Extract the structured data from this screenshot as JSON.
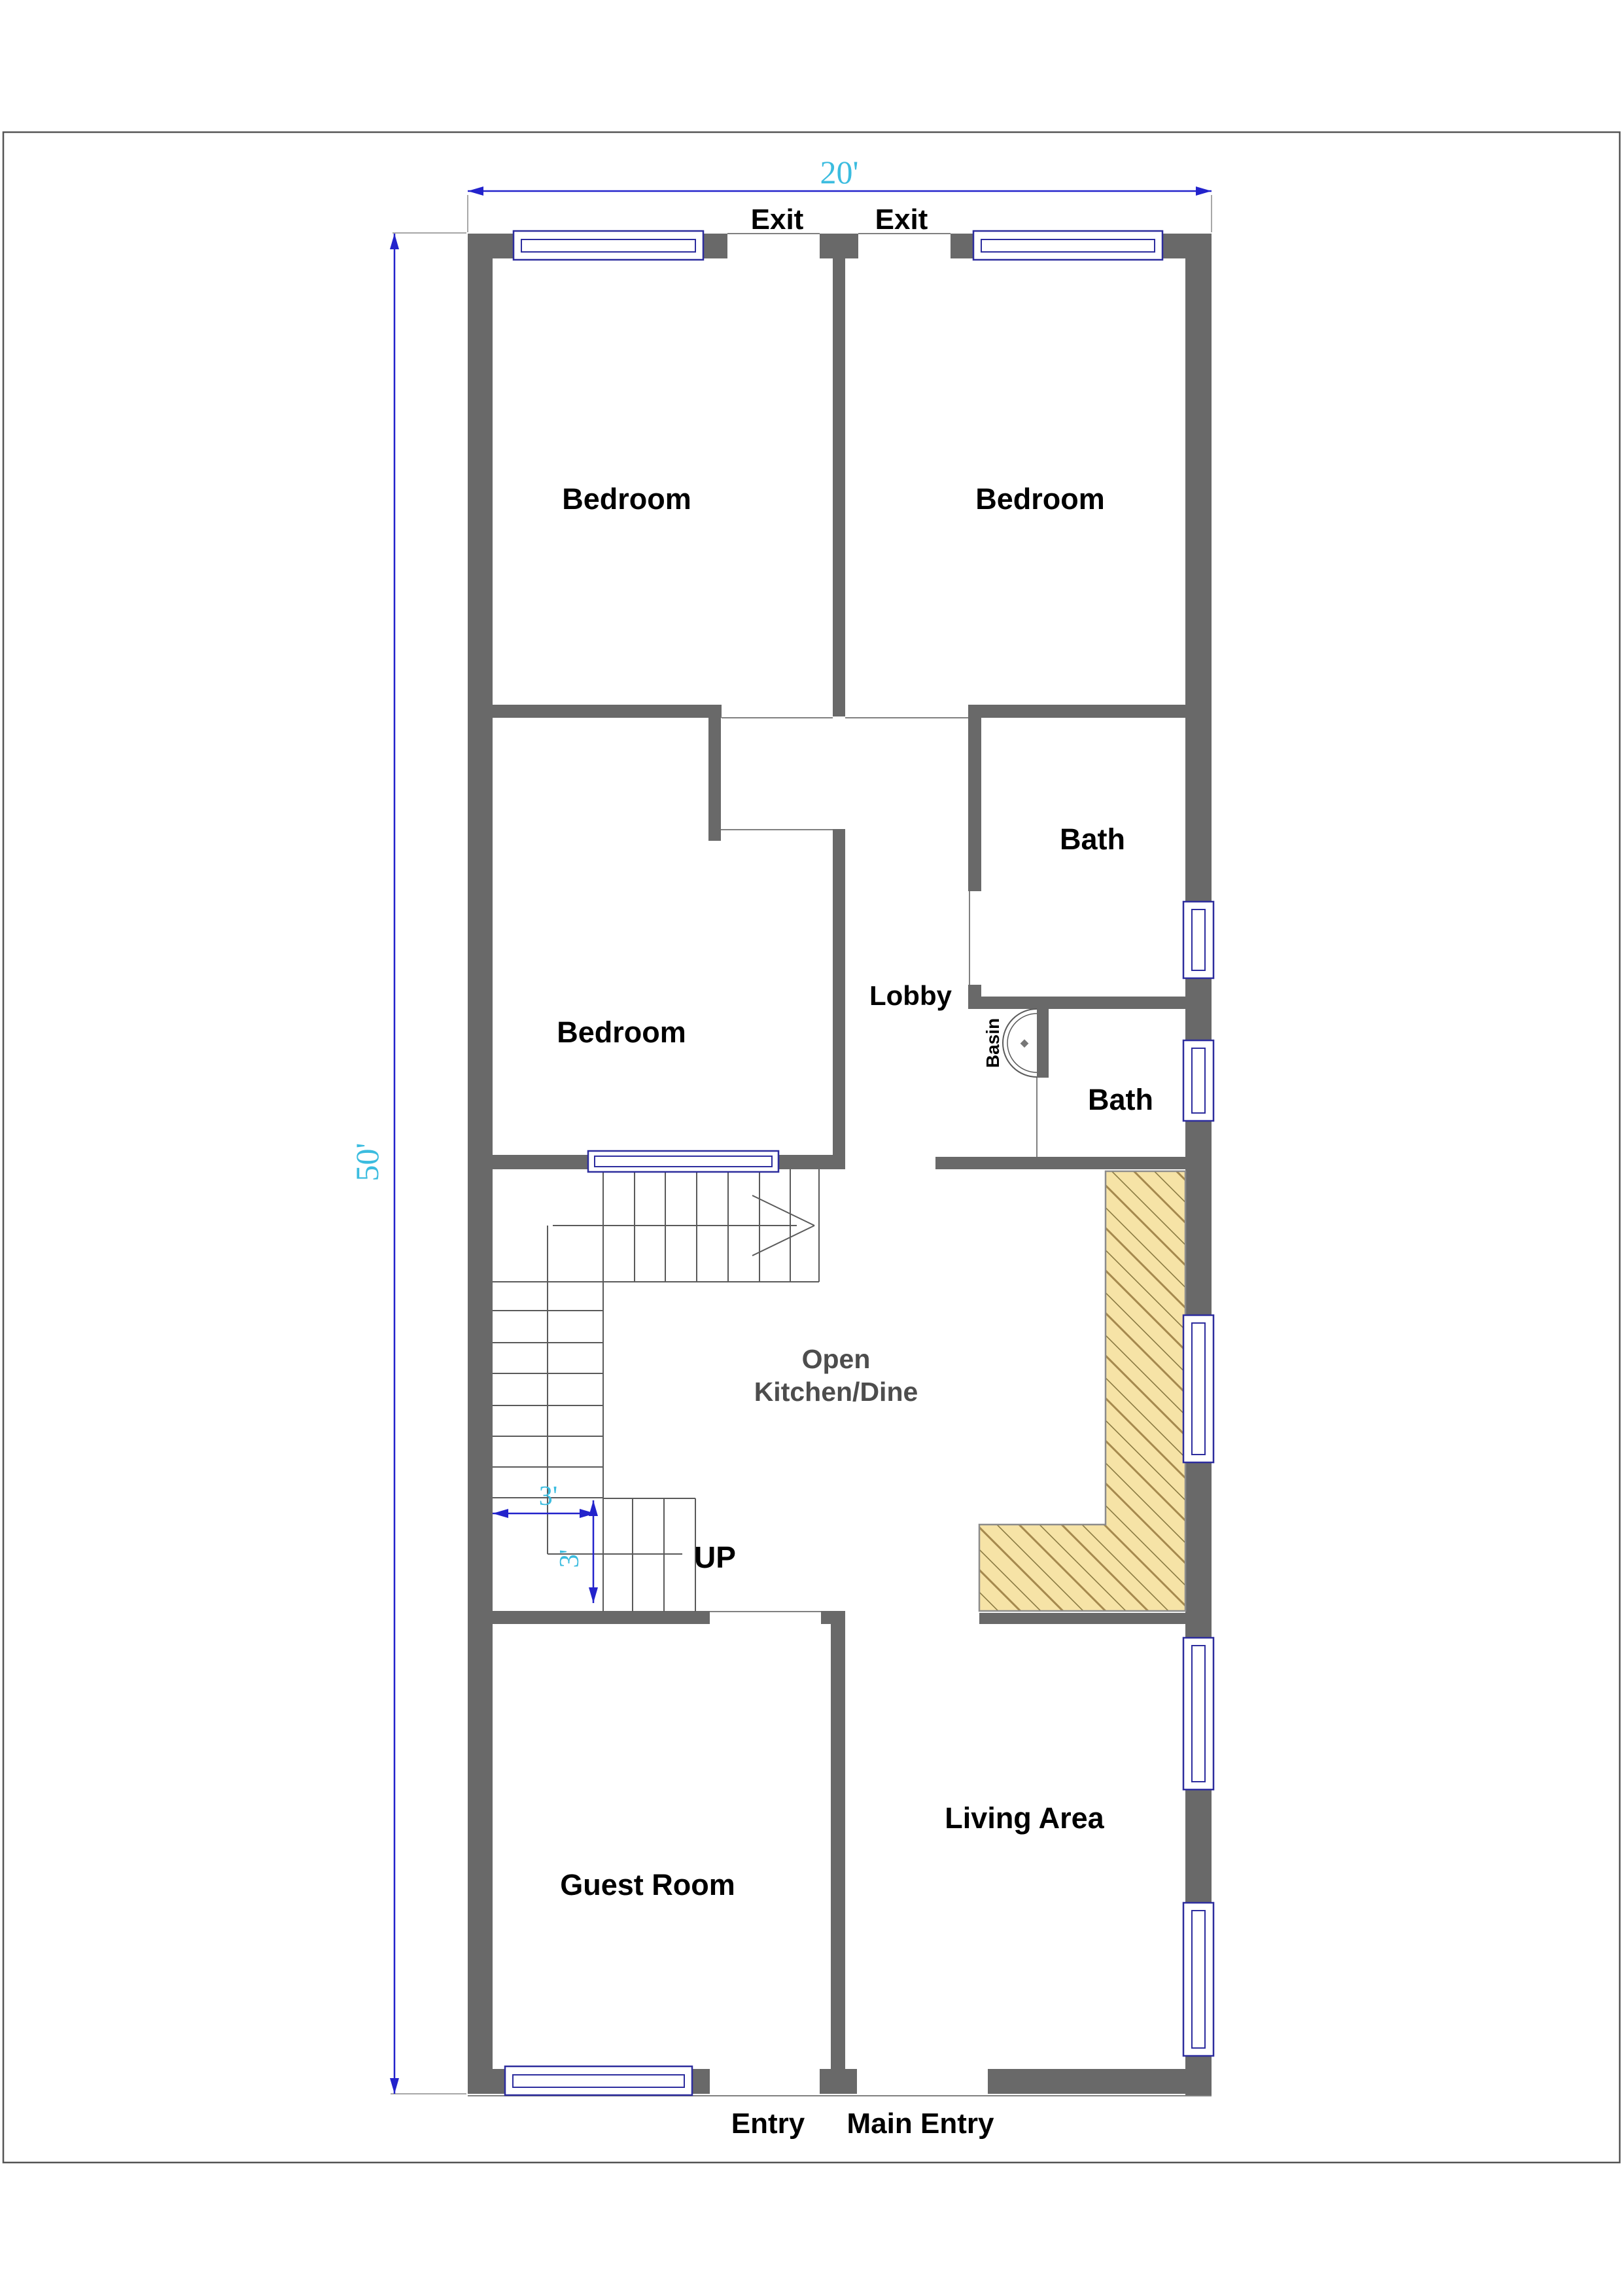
{
  "drawing": {
    "type": "floor-plan",
    "dimensions": {
      "width_total": "20'",
      "height_total": "50'",
      "stair_width": "3'",
      "stair_depth": "3'"
    },
    "labels": {
      "exit_left": "Exit",
      "exit_right": "Exit",
      "bedroom_top_left": "Bedroom",
      "bedroom_top_right": "Bedroom",
      "bath_upper": "Bath",
      "bath_lower": "Bath",
      "lobby": "Lobby",
      "basin": "Basin",
      "bedroom_middle": "Bedroom",
      "kitchen_line1": "Open",
      "kitchen_line2": "Kitchen/Dine",
      "up": "UP",
      "guest_room": "Guest Room",
      "living_area": "Living Area",
      "entry": "Entry",
      "main_entry": "Main Entry"
    },
    "colors": {
      "wall": "#696969",
      "window_frame": "#2d2d9e",
      "dim_line": "#2323cc",
      "dim_text": "#3bbcdf",
      "hatch_bg": "#f6e3a6",
      "hatch_line": "#a5894e",
      "hatch_line_dark": "#7a6a33",
      "label": "#000000",
      "label_muted": "#4d4d4d",
      "thin_line": "#808080",
      "frame": "#555555"
    }
  }
}
